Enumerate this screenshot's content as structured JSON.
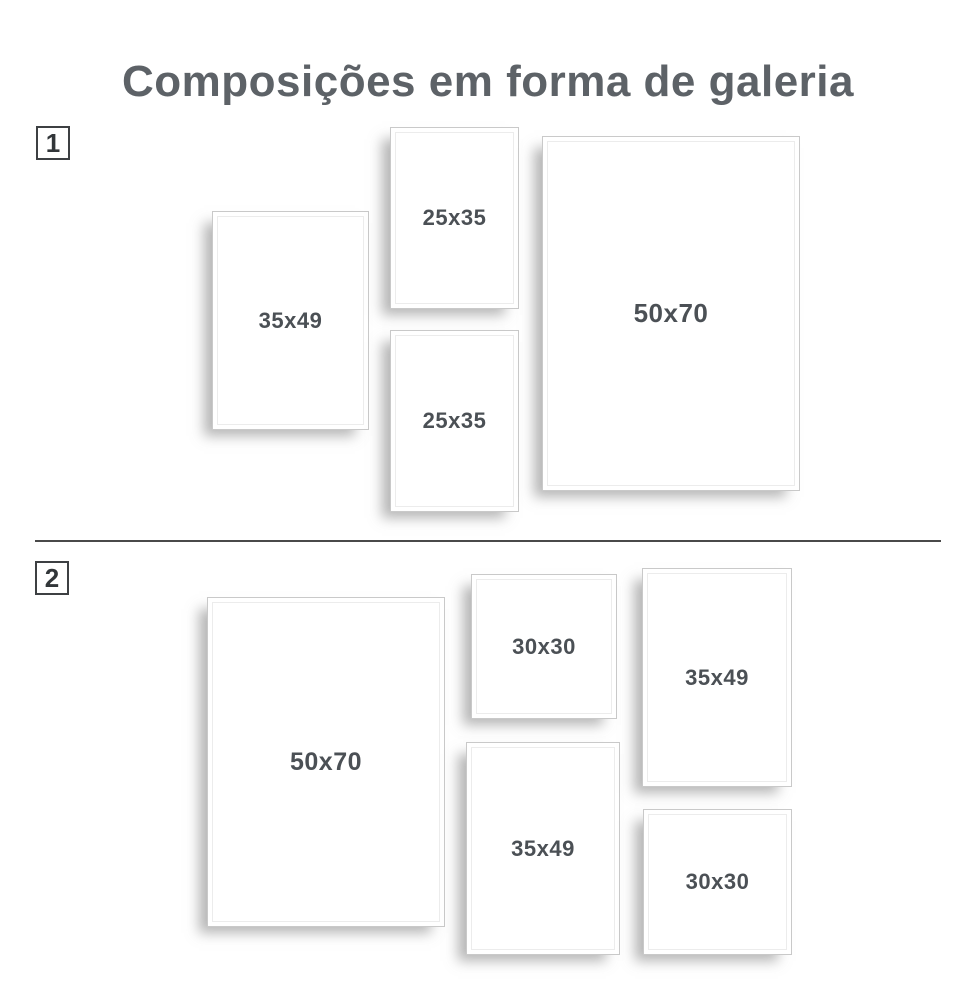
{
  "title": "Composições em forma de galeria",
  "colors": {
    "title_text": "#5d6267",
    "label_text": "#4b5055",
    "frame_border": "#c9c9c9",
    "divider": "#4a4a4a",
    "badge_border": "#3d4043",
    "background": "#ffffff"
  },
  "sections": [
    {
      "badge": "1",
      "frames": [
        {
          "label": "35x49"
        },
        {
          "label": "25x35"
        },
        {
          "label": "25x35"
        },
        {
          "label": "50x70"
        }
      ]
    },
    {
      "badge": "2",
      "frames": [
        {
          "label": "50x70"
        },
        {
          "label": "30x30"
        },
        {
          "label": "35x49"
        },
        {
          "label": "35x49"
        },
        {
          "label": "30x30"
        }
      ]
    }
  ]
}
